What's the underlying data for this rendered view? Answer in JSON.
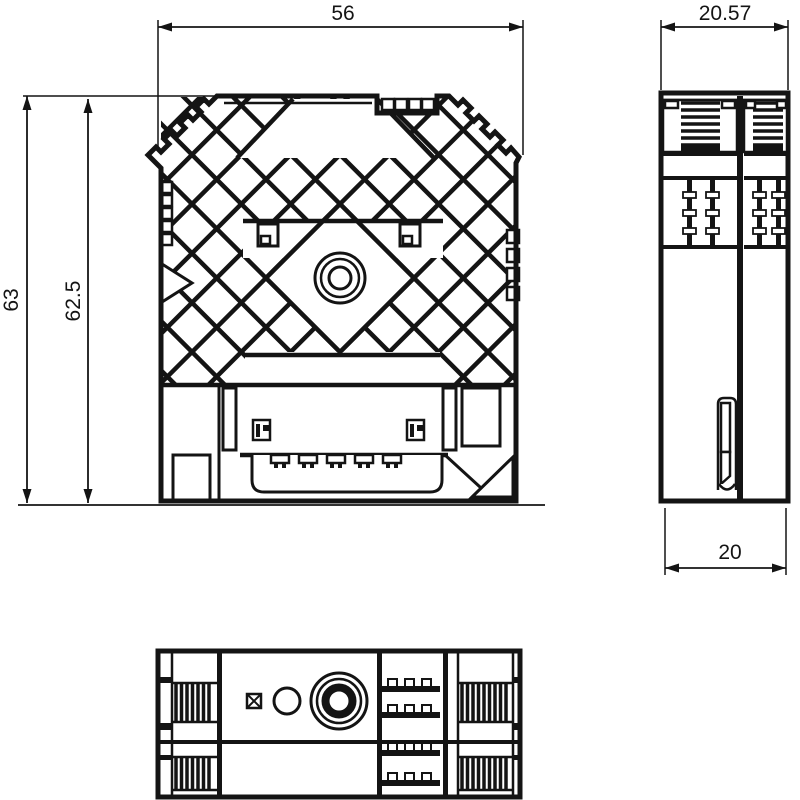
{
  "colors": {
    "line": "#141414",
    "background": "#ffffff"
  },
  "dimensions": {
    "front_width": "56",
    "front_total_height": "63",
    "front_body_height": "62.5",
    "side_top_width": "20.57",
    "side_bottom_width": "20"
  }
}
